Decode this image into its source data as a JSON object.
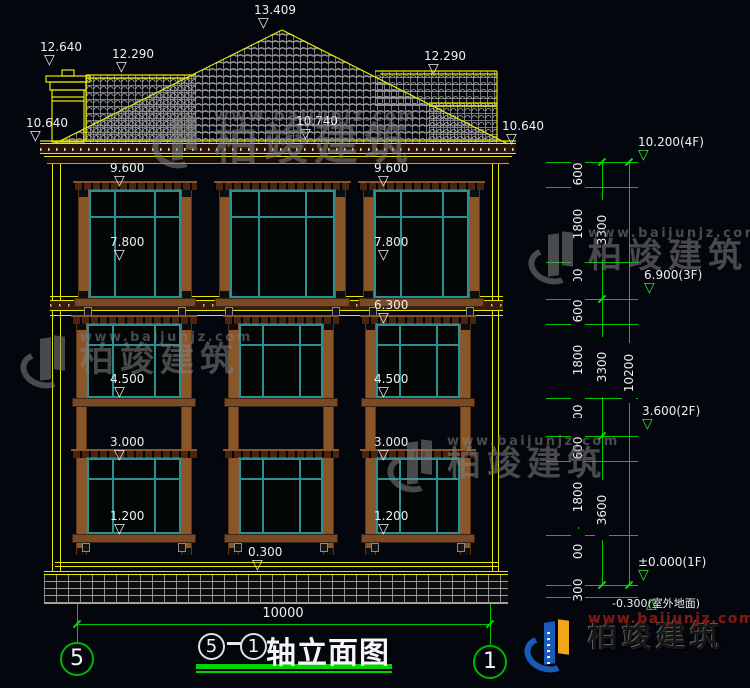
{
  "watermark": {
    "name": "柏竣建筑",
    "url": "www.baijunjz.com"
  },
  "logo": {
    "name": "柏竣建筑",
    "url": "www.baijunjz.com"
  },
  "roof_markers": {
    "peak": "13.409",
    "chimney": "12.640",
    "ridge_left": "12.290",
    "ridge_right": "12.290",
    "eave_left": "10.640",
    "eave_center": "10.740",
    "eave_right": "10.640"
  },
  "facade_markers": {
    "f3_head_left": "9.600",
    "f3_head_right": "9.600",
    "f3_sill_left": "7.800",
    "f3_sill_right": "7.800",
    "f2_head": "6.300",
    "f2_sill_left": "4.500",
    "f2_sill_right": "4.500",
    "f1_head_left": "3.000",
    "f1_head_right": "3.000",
    "f1_sill_left": "1.200",
    "f1_sill_right": "1.200",
    "plinth_top": "0.300"
  },
  "level_markers": [
    {
      "id": "4F",
      "text": "10.200(4F)"
    },
    {
      "id": "3F",
      "text": "6.900(3F)"
    },
    {
      "id": "2F",
      "text": "3.600(2F)"
    },
    {
      "id": "1F",
      "text": "±0.000(1F)"
    },
    {
      "id": "ground",
      "text": "-0.300(室外地面)"
    }
  ],
  "dim_column": {
    "segments": [
      "600",
      "1800",
      "900",
      "600",
      "1800",
      "900",
      "600",
      "1800",
      "1200",
      "300"
    ],
    "tiers": [
      "3300",
      "3300",
      "3600"
    ],
    "total": "10200"
  },
  "bottom": {
    "width_dim": "10000",
    "axis_left": "5",
    "axis_right": "1",
    "title": {
      "start_axis": "5",
      "separator": "-",
      "end_axis": "1",
      "text": "轴立面图"
    }
  },
  "colors": {
    "line_yellow": "#e8e800",
    "line_green": "#00d400",
    "line_white": "#f0f0f0",
    "window_teal": "#2a9090",
    "wood_brown": "#8a5527",
    "logo_blue": "#1a5ab8",
    "logo_orange": "#f2a41c",
    "logo_red": "#7e1b10"
  }
}
